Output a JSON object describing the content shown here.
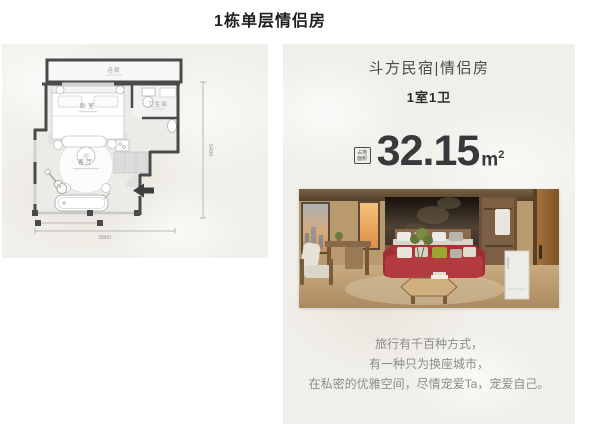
{
  "page": {
    "title": "1栋单层情侣房"
  },
  "floor_plan": {
    "corridor_label": "连廊",
    "bedroom_label": "卧室",
    "bathroom_label": "卫生间",
    "living_room_label": "客厅",
    "width_dim": "5800",
    "height_dim": "5400"
  },
  "listing": {
    "name": "斗方民宿|情侣房",
    "layout": "1室1卫",
    "area_icon_line1": "占地",
    "area_icon_line2": "面积",
    "area_value": "32.15",
    "area_unit": "m",
    "area_unit_sup": "2",
    "description": [
      "旅行有千百种方式，",
      "有一种只为换座城市，",
      "在私密的优雅空间，尽情宠爱Ta，宠爱自己。"
    ]
  },
  "colors": {
    "sofa_red": "#b23a3e",
    "wall_dark": "#4a4a4a",
    "text_dark": "#2d2d2f",
    "text_gray": "#8c8c8a",
    "paper": "#f1efe9"
  }
}
